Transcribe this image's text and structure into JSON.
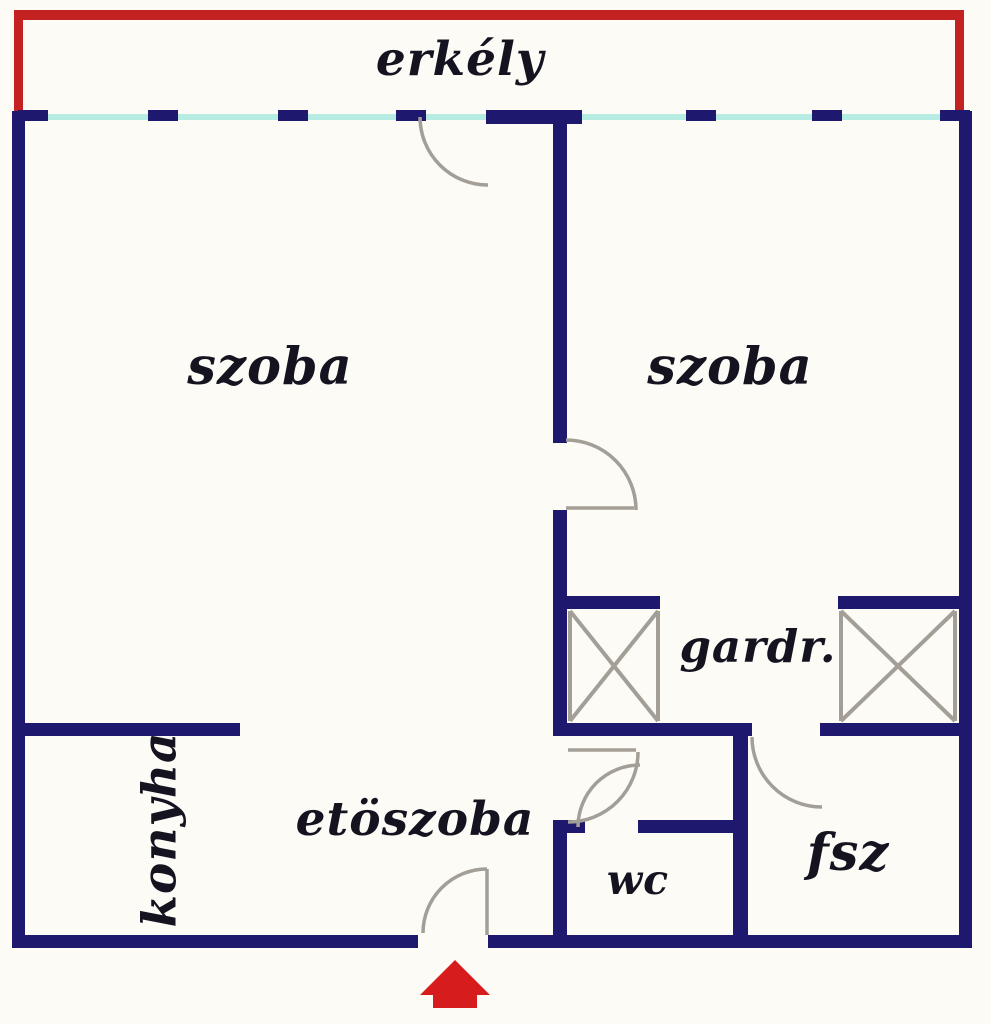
{
  "floorplan": {
    "rooms": {
      "balcony": {
        "label": "erkély"
      },
      "room_left": {
        "label": "szoba"
      },
      "room_right": {
        "label": "szoba"
      },
      "wardrobe": {
        "label": "gardr."
      },
      "kitchen": {
        "label": "konyha"
      },
      "hallway": {
        "label": "etöszoba"
      },
      "wc": {
        "label": "wc"
      },
      "bathroom": {
        "label": "fsz"
      }
    },
    "icons": {
      "entrance_marker": "red-house-entrance-arrow"
    },
    "colors": {
      "wall": "#1e196e",
      "balcony_outline": "#c42222",
      "window_glass": "#b7ece2",
      "door_arc": "#a39f96",
      "entrance_marker": "#d61c1c",
      "label_text": "#15131f",
      "background": "#fcfbf6"
    }
  }
}
